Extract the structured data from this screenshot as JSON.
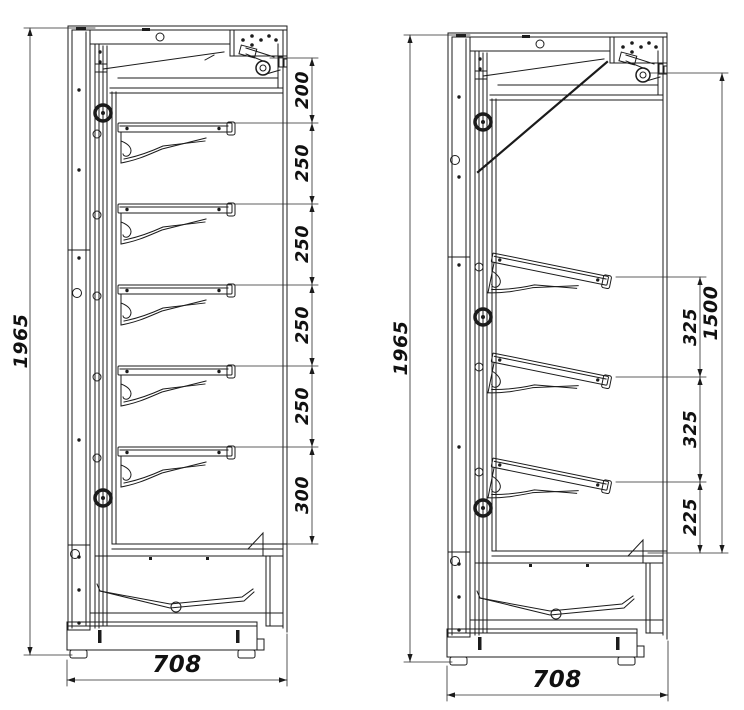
{
  "drawing": {
    "description": "Two side-section technical drawings of an open-front refrigerated multideck cabinet",
    "left_view": {
      "overall_height_mm": "1965",
      "overall_depth_mm": "708",
      "shelf_spacings_mm": [
        "200",
        "250",
        "250",
        "250",
        "250",
        "300"
      ]
    },
    "right_view": {
      "overall_height_mm": "1965",
      "overall_depth_mm": "708",
      "shelf_spacings_mm": [
        "325",
        "325",
        "225"
      ],
      "display_zone_height_mm": "1500"
    }
  }
}
